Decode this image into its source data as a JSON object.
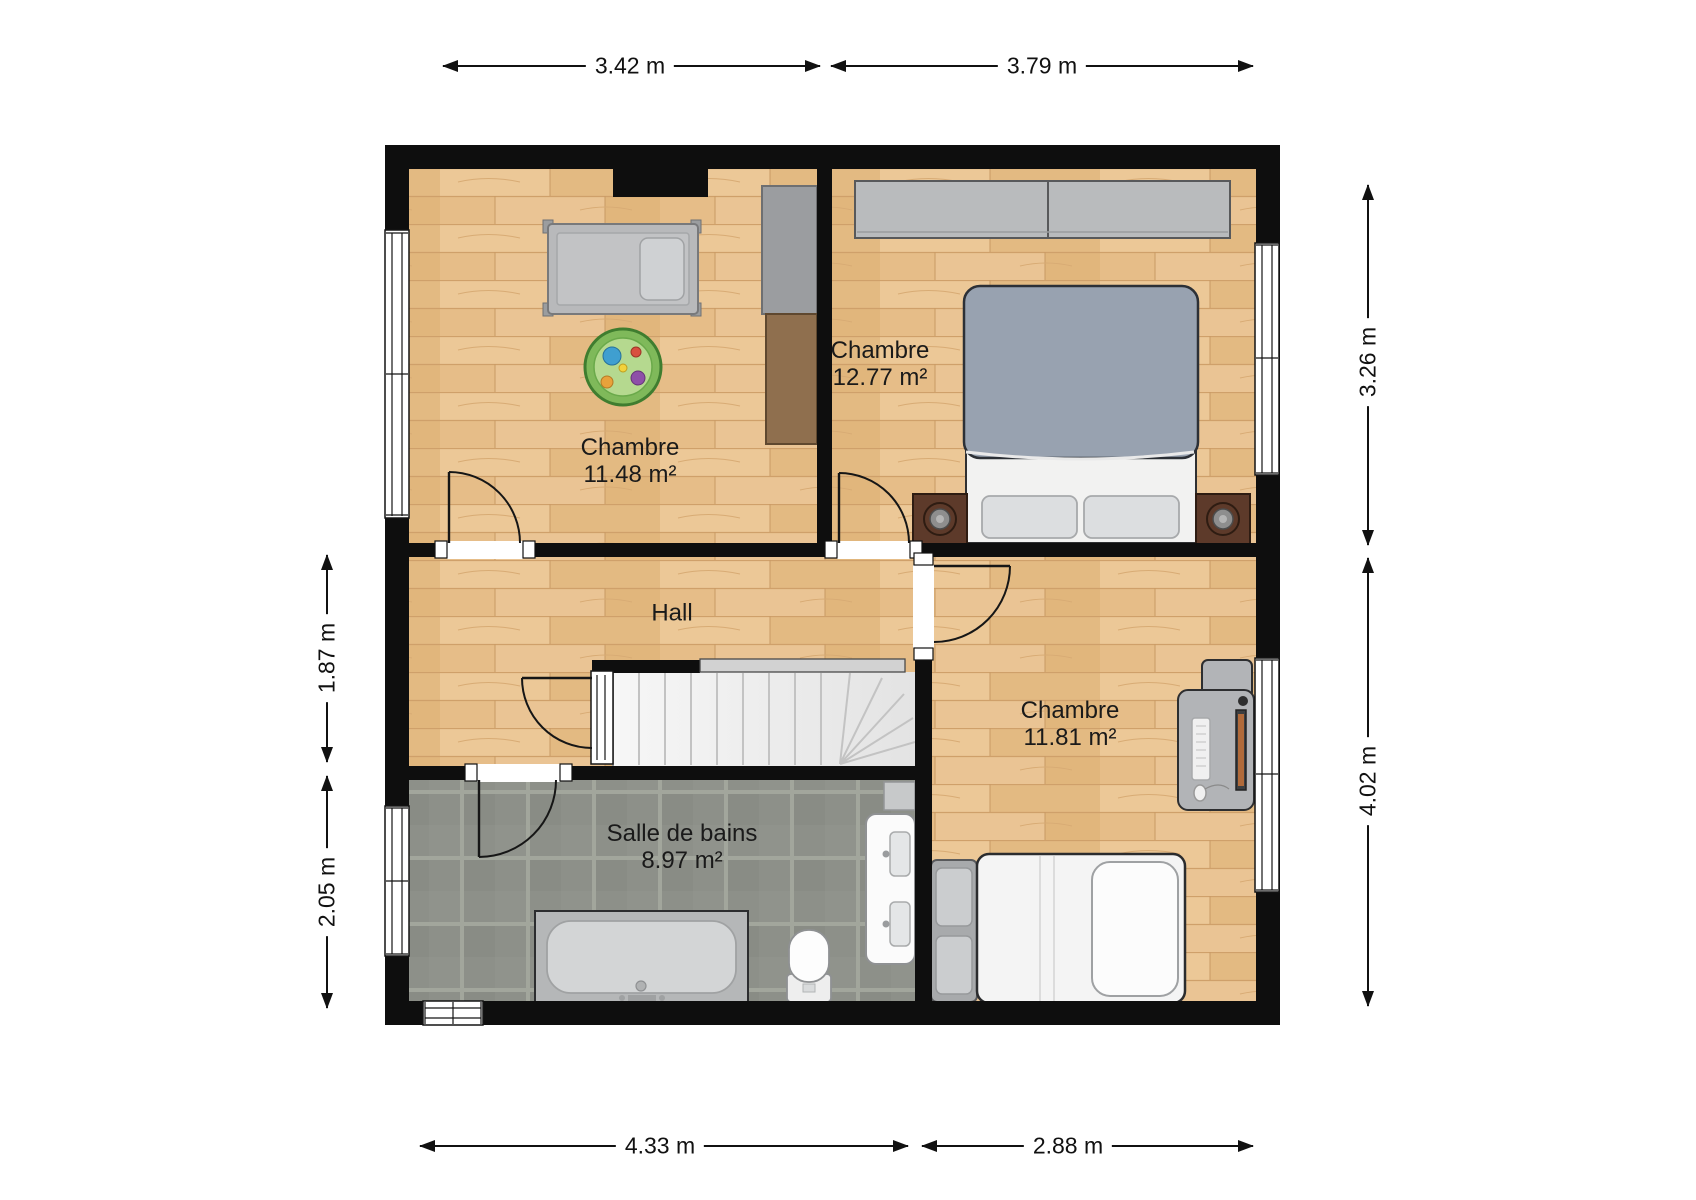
{
  "rooms": {
    "bedroom1": {
      "name": "Chambre",
      "area": "11.48 m²"
    },
    "bedroom2": {
      "name": "Chambre",
      "area": "12.77 m²"
    },
    "bedroom3": {
      "name": "Chambre",
      "area": "11.81 m²"
    },
    "hall": {
      "name": "Hall"
    },
    "bathroom": {
      "name": "Salle de bains",
      "area": "8.97 m²"
    }
  },
  "dimensions": {
    "top_left": "3.42 m",
    "top_right": "3.79 m",
    "bottom_left": "4.33 m",
    "bottom_right": "2.88 m",
    "left_upper": "1.87 m",
    "left_lower": "2.05 m",
    "right_upper": "3.26 m",
    "right_lower": "4.02 m"
  },
  "furniture": [
    "crib",
    "play-rug",
    "tall-cabinet",
    "wardrobe",
    "double-bed",
    "nightstand-left",
    "nightstand-right",
    "desk-computer",
    "single-bed",
    "bench",
    "bathtub",
    "toilet",
    "sink-vanity",
    "stairs"
  ],
  "colors": {
    "wall": "#0e0e0e",
    "wood_floor": "#e8c28e",
    "wood_grain": "#cfa06a",
    "tile_floor": "#8d9089",
    "tile_grout": "#a3a79d",
    "stairs": "#efefef",
    "furniture_gray": "#b7b9bb",
    "bed_duvet": "#98a2b0",
    "nightstand_brown": "#5d3a2a",
    "rug_green": "#7fb95a",
    "fixture_white": "#f5f5f5"
  }
}
